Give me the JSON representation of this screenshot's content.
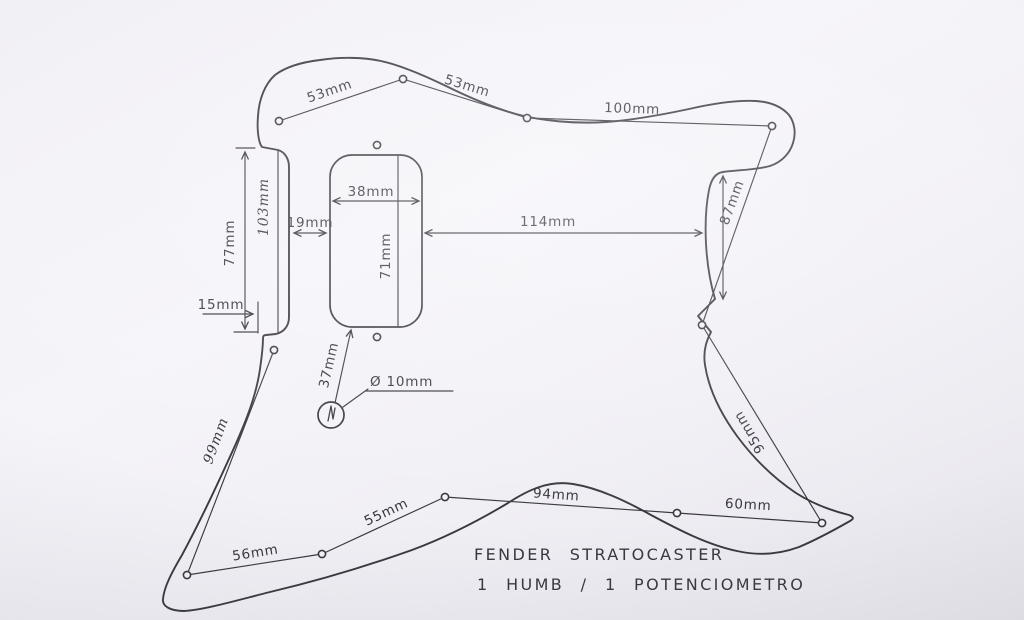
{
  "title": {
    "line1": "FENDER STRATOCASTER",
    "line2": "1 HUMB / 1 POTENCIOMETRO"
  },
  "dimensions": {
    "top_left": "53mm",
    "top_right": "53mm",
    "top_long": "100mm",
    "right_upper": "87mm",
    "right_lower": "95mm",
    "bottom_right": "60mm",
    "bottom_mid": "94mm",
    "bottom_mid_left": "55mm",
    "bottom_left": "56mm",
    "left_diag": "99mm",
    "pocket_height": "77mm",
    "pocket_length": "103mm",
    "edge_offset": "15mm",
    "pickup_gap": "19mm",
    "pickup_width": "38mm",
    "pickup_height": "71mm",
    "pickup_to_edge": "114mm",
    "pot_offset": "37mm",
    "pot_diameter": "Ø 10mm"
  },
  "colors": {
    "ink": "#3a383e",
    "paper": "#f3f2f7"
  }
}
